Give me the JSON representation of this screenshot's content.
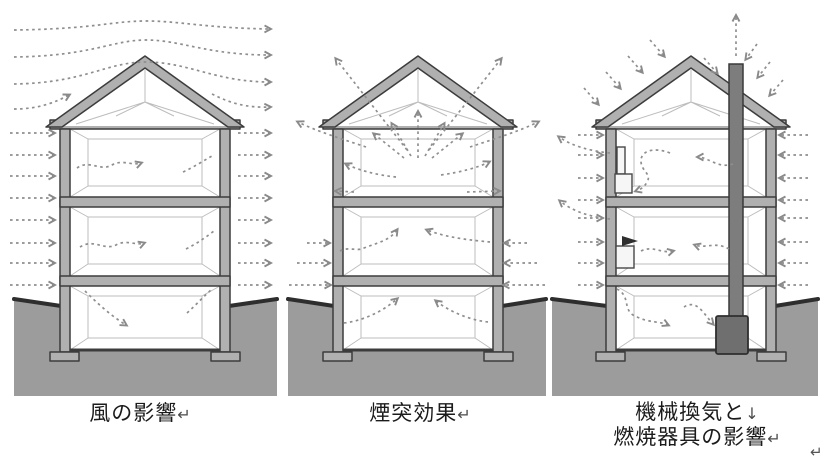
{
  "figures": [
    {
      "id": "wind",
      "caption": "風の影響",
      "end_mark": "↵"
    },
    {
      "id": "stack",
      "caption": "煙突効果",
      "end_mark": "↵"
    },
    {
      "id": "mechanical",
      "caption_line1": "機械換気と",
      "line_break_mark": "↓",
      "caption_line2": "燃焼器具の影響",
      "end_mark": "↵"
    }
  ],
  "trailing_paragraph_mark": "↵",
  "colors": {
    "background": "#ffffff",
    "ground": "#9c9c9c",
    "ground_edge": "#2e2e2e",
    "structure_fill": "#b0b0b0",
    "structure_outline": "#3c3c3c",
    "arrow": "#8f8f8f",
    "chimney": "#7d7d7d",
    "stove": "#6f6f6f",
    "caption_text": "#1b1b1b"
  }
}
